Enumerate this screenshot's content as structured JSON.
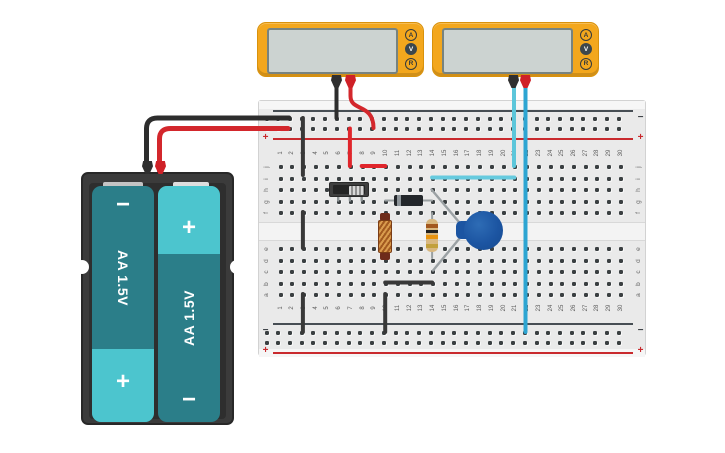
{
  "scene": {
    "background": "#ffffff"
  },
  "multimeters": [
    {
      "id": "multimeter-1",
      "screen_value": "",
      "buttons": [
        "A",
        "V",
        "R"
      ],
      "active_button": "V",
      "body_color": "#f3a71d",
      "screen_color": "#ccd3d1",
      "probes": [
        {
          "name": "negative-probe",
          "color": "#2f2f2f"
        },
        {
          "name": "positive-probe",
          "color": "#cf2127"
        }
      ]
    },
    {
      "id": "multimeter-2",
      "screen_value": "",
      "buttons": [
        "A",
        "V",
        "R"
      ],
      "active_button": "V",
      "body_color": "#f3a71d",
      "screen_color": "#ccd3d1",
      "probes": [
        {
          "name": "negative-probe",
          "color": "#2f2f2f"
        },
        {
          "name": "positive-probe",
          "color": "#cf2127"
        }
      ]
    }
  ],
  "battery_pack": {
    "body_color": "#3b3b3b",
    "batteries": [
      {
        "label": "AA 1.5V",
        "top_terminal": "−",
        "bottom_terminal": "+",
        "body_color": "#2b7e89",
        "cap_color": "#4cc5ce"
      },
      {
        "label": "AA 1.5V",
        "top_terminal": "+",
        "bottom_terminal": "−",
        "body_color": "#2b7e89",
        "cap_color": "#4cc5ce"
      }
    ]
  },
  "breadboard": {
    "columns": [
      "1",
      "2",
      "3",
      "4",
      "5",
      "6",
      "7",
      "8",
      "9",
      "10",
      "11",
      "12",
      "13",
      "14",
      "15",
      "16",
      "17",
      "18",
      "19",
      "20",
      "21",
      "22",
      "23",
      "24",
      "25",
      "26",
      "27",
      "28",
      "29",
      "30"
    ],
    "row_letters_top": [
      "j",
      "i",
      "h",
      "g",
      "f"
    ],
    "row_letters_bottom": [
      "e",
      "d",
      "c",
      "b",
      "a"
    ],
    "negative_label": "−",
    "positive_label": "+",
    "negative_color": "#3c4146",
    "positive_color": "#c92a2e"
  },
  "components": {
    "slide_switch": {
      "type": "slide switch",
      "position": "row g, columns 6-8"
    },
    "diode": {
      "type": "diode",
      "position": "row g, columns 10-14",
      "band_side": "left"
    },
    "inductor": {
      "type": "inductor",
      "position": "column 10, rows f-d"
    },
    "resistor": {
      "type": "resistor",
      "position": "column 14, rows f-d",
      "bands": [
        "#a3581f",
        "#1f1f1f",
        "#e8930f",
        "#c2a03c"
      ]
    },
    "capacitor": {
      "type": "capacitor",
      "position": "column 14, rows h-c",
      "color": "#1c55a2"
    }
  },
  "wires": [
    {
      "name": "battery-negative-wire",
      "color": "#2d2d2d",
      "width": 5,
      "path": "M146.5 168 L146.5 129 Q146.5 118 157.5 118 L289 118"
    },
    {
      "name": "battery-positive-wire",
      "color": "#d3272c",
      "width": 5,
      "path": "M159.5 171 L159.5 139 Q159.5 128.5 170.5 128.5 L288 128.5"
    },
    {
      "name": "mm1-negative-probe-wire",
      "color": "#2d2d2d",
      "width": 4,
      "path": "M336.5 84 L336.5 118"
    },
    {
      "name": "mm1-positive-probe-wire",
      "color": "#d3272c",
      "width": 4,
      "path": "M350.5 84 L350.5 96 C350.5 112 373.5 103 373.5 128"
    },
    {
      "name": "mm2-negative-probe-wire",
      "color": "#5cc6da",
      "width": 4,
      "path": "M514 84 L514 166"
    },
    {
      "name": "mm2-positive-probe-wire",
      "color": "#2da5d2",
      "width": 4,
      "path": "M525.5 84 L525.5 332"
    },
    {
      "name": "jumper-black-rail-to-row-i-col3",
      "color": "#383838",
      "width": 4,
      "path": "M302.9 118 L302.9 175"
    },
    {
      "name": "jumper-red-rail-to-row-j-col7",
      "color": "#e0252b",
      "width": 4,
      "path": "M349.9 128.5 L349.9 166"
    },
    {
      "name": "jumper-red-row-j-col8-col10",
      "color": "#e0252b",
      "width": 4,
      "path": "M361.7 166 L385.2 166"
    },
    {
      "name": "jumper-cyan-row-i-col14-col21",
      "color": "#66cade",
      "width": 4,
      "path": "M432.1 177.5 L514.3 177.5"
    },
    {
      "name": "jumper-black-row-f-to-e-col3",
      "color": "#383838",
      "width": 4,
      "path": "M302.9 212 L302.9 248"
    },
    {
      "name": "jumper-black-row-a-to-rail-col3",
      "color": "#383838",
      "width": 4,
      "path": "M302.9 294 L302.9 332"
    },
    {
      "name": "jumper-black-row-a-to-rail-col10",
      "color": "#383838",
      "width": 4,
      "path": "M385.2 294 L385.2 332"
    },
    {
      "name": "jumper-black-row-b-col10-col14",
      "color": "#383838",
      "width": 4,
      "path": "M385.2 282.5 L432.1 282.5"
    }
  ]
}
